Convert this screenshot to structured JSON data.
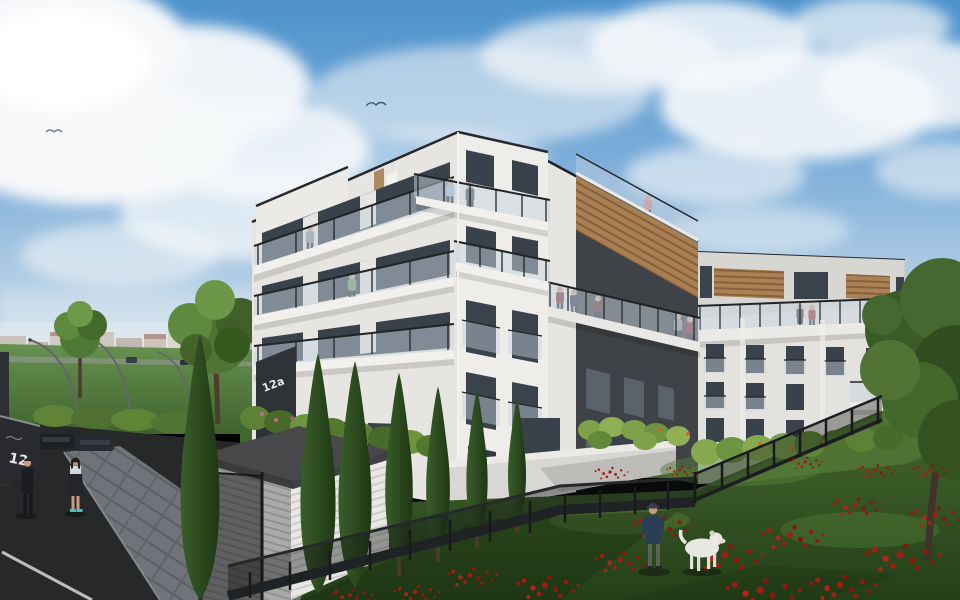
{
  "scene": {
    "type": "architectural 3D visualization",
    "title": "Modern residential estate exterior render",
    "conditions": "daytime, partly cloudy blue sky",
    "signs": {
      "entrance_panel": "12a",
      "gate_wall": "12"
    },
    "buildings": {
      "count": 3,
      "stories": 5,
      "style": "modern flat-roof apartment blocks",
      "features": [
        "white plaster facades",
        "glass balcony balustrades with black steel posts",
        "anthracite accent walls",
        "timber cladding on top floors",
        "floor-to-ceiling windows",
        "rooftop terraces"
      ]
    },
    "landscape": {
      "foreground": "wild grass meadow with red poppies",
      "boundary": "black metal mesh fence with hedges and italian cypresses",
      "left_side": "paved sidewalk, asphalt road, parked cars behind dark gate wall, green field, distant town skyline, arched street lamps, deciduous trees",
      "structures": [
        "white slatted utility shed with dark flat roof"
      ]
    },
    "figures": {
      "sidewalk_pedestrians": 2,
      "dog_walker": 1,
      "dog": "white dog",
      "balcony_residents": 17
    },
    "palette": {
      "sky_blue": "#4d92cc",
      "cloud_white": "#f6f8fa",
      "facade_white": "#e7e5e1",
      "anthracite": "#3f4347",
      "timber": "#a87f52",
      "window_glass": "#39424b",
      "balustrade_glass": "#c7d3df",
      "hedge_green": "#5d8136",
      "cypress_green": "#2b4721",
      "meadow_green": "#3a5a28",
      "poppy_red": "#a11d14",
      "asphalt": "#26282a",
      "pavement_grey": "#70747a"
    }
  }
}
